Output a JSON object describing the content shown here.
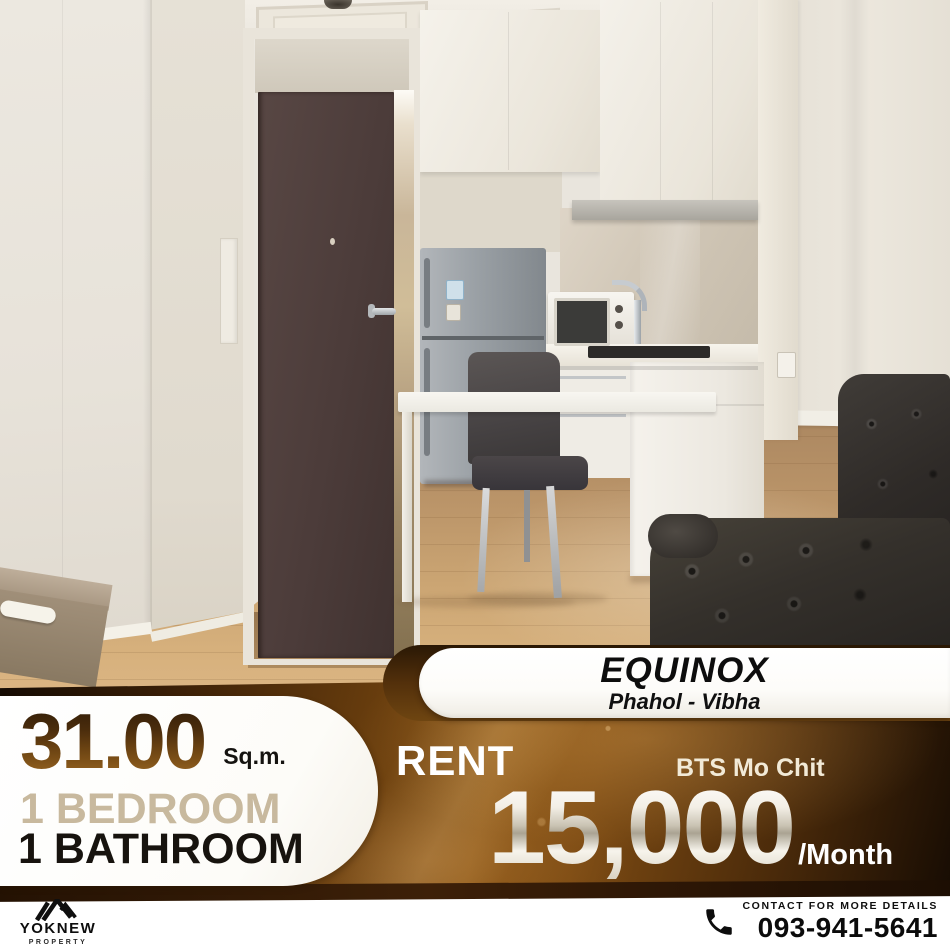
{
  "listing": {
    "project_name": "EQUINOX",
    "project_location": "Phahol - Vibha",
    "area_value": "31.00",
    "area_unit": "Sq.m.",
    "bedrooms": "1 BEDROOM",
    "bathrooms": "1 BATHROOM",
    "deal_type": "RENT",
    "transit_station": "BTS Mo Chit",
    "price": "15,000",
    "price_period": "/Month"
  },
  "brand": {
    "name": "YOKNEW",
    "tagline": "PROPERTY"
  },
  "contact": {
    "label": "CONTACT FOR MORE DETAILS",
    "phone": "093-941-5641"
  },
  "icons": {
    "brand_mark": "roof-chevrons-icon",
    "phone": "phone-receiver-icon"
  },
  "colors": {
    "band_dark": "#170c03",
    "band_gold": "#8a5516",
    "badge_bg": "#ffffff",
    "area_number_top": "#2e1b08",
    "area_number_bottom": "#95661f",
    "bedroom_text": "#c8b99e",
    "bathroom_text": "#17130e",
    "price_metallic": "#cfc8b8",
    "footer_bg": "#ffffff",
    "footer_text": "#0d0d0d"
  }
}
